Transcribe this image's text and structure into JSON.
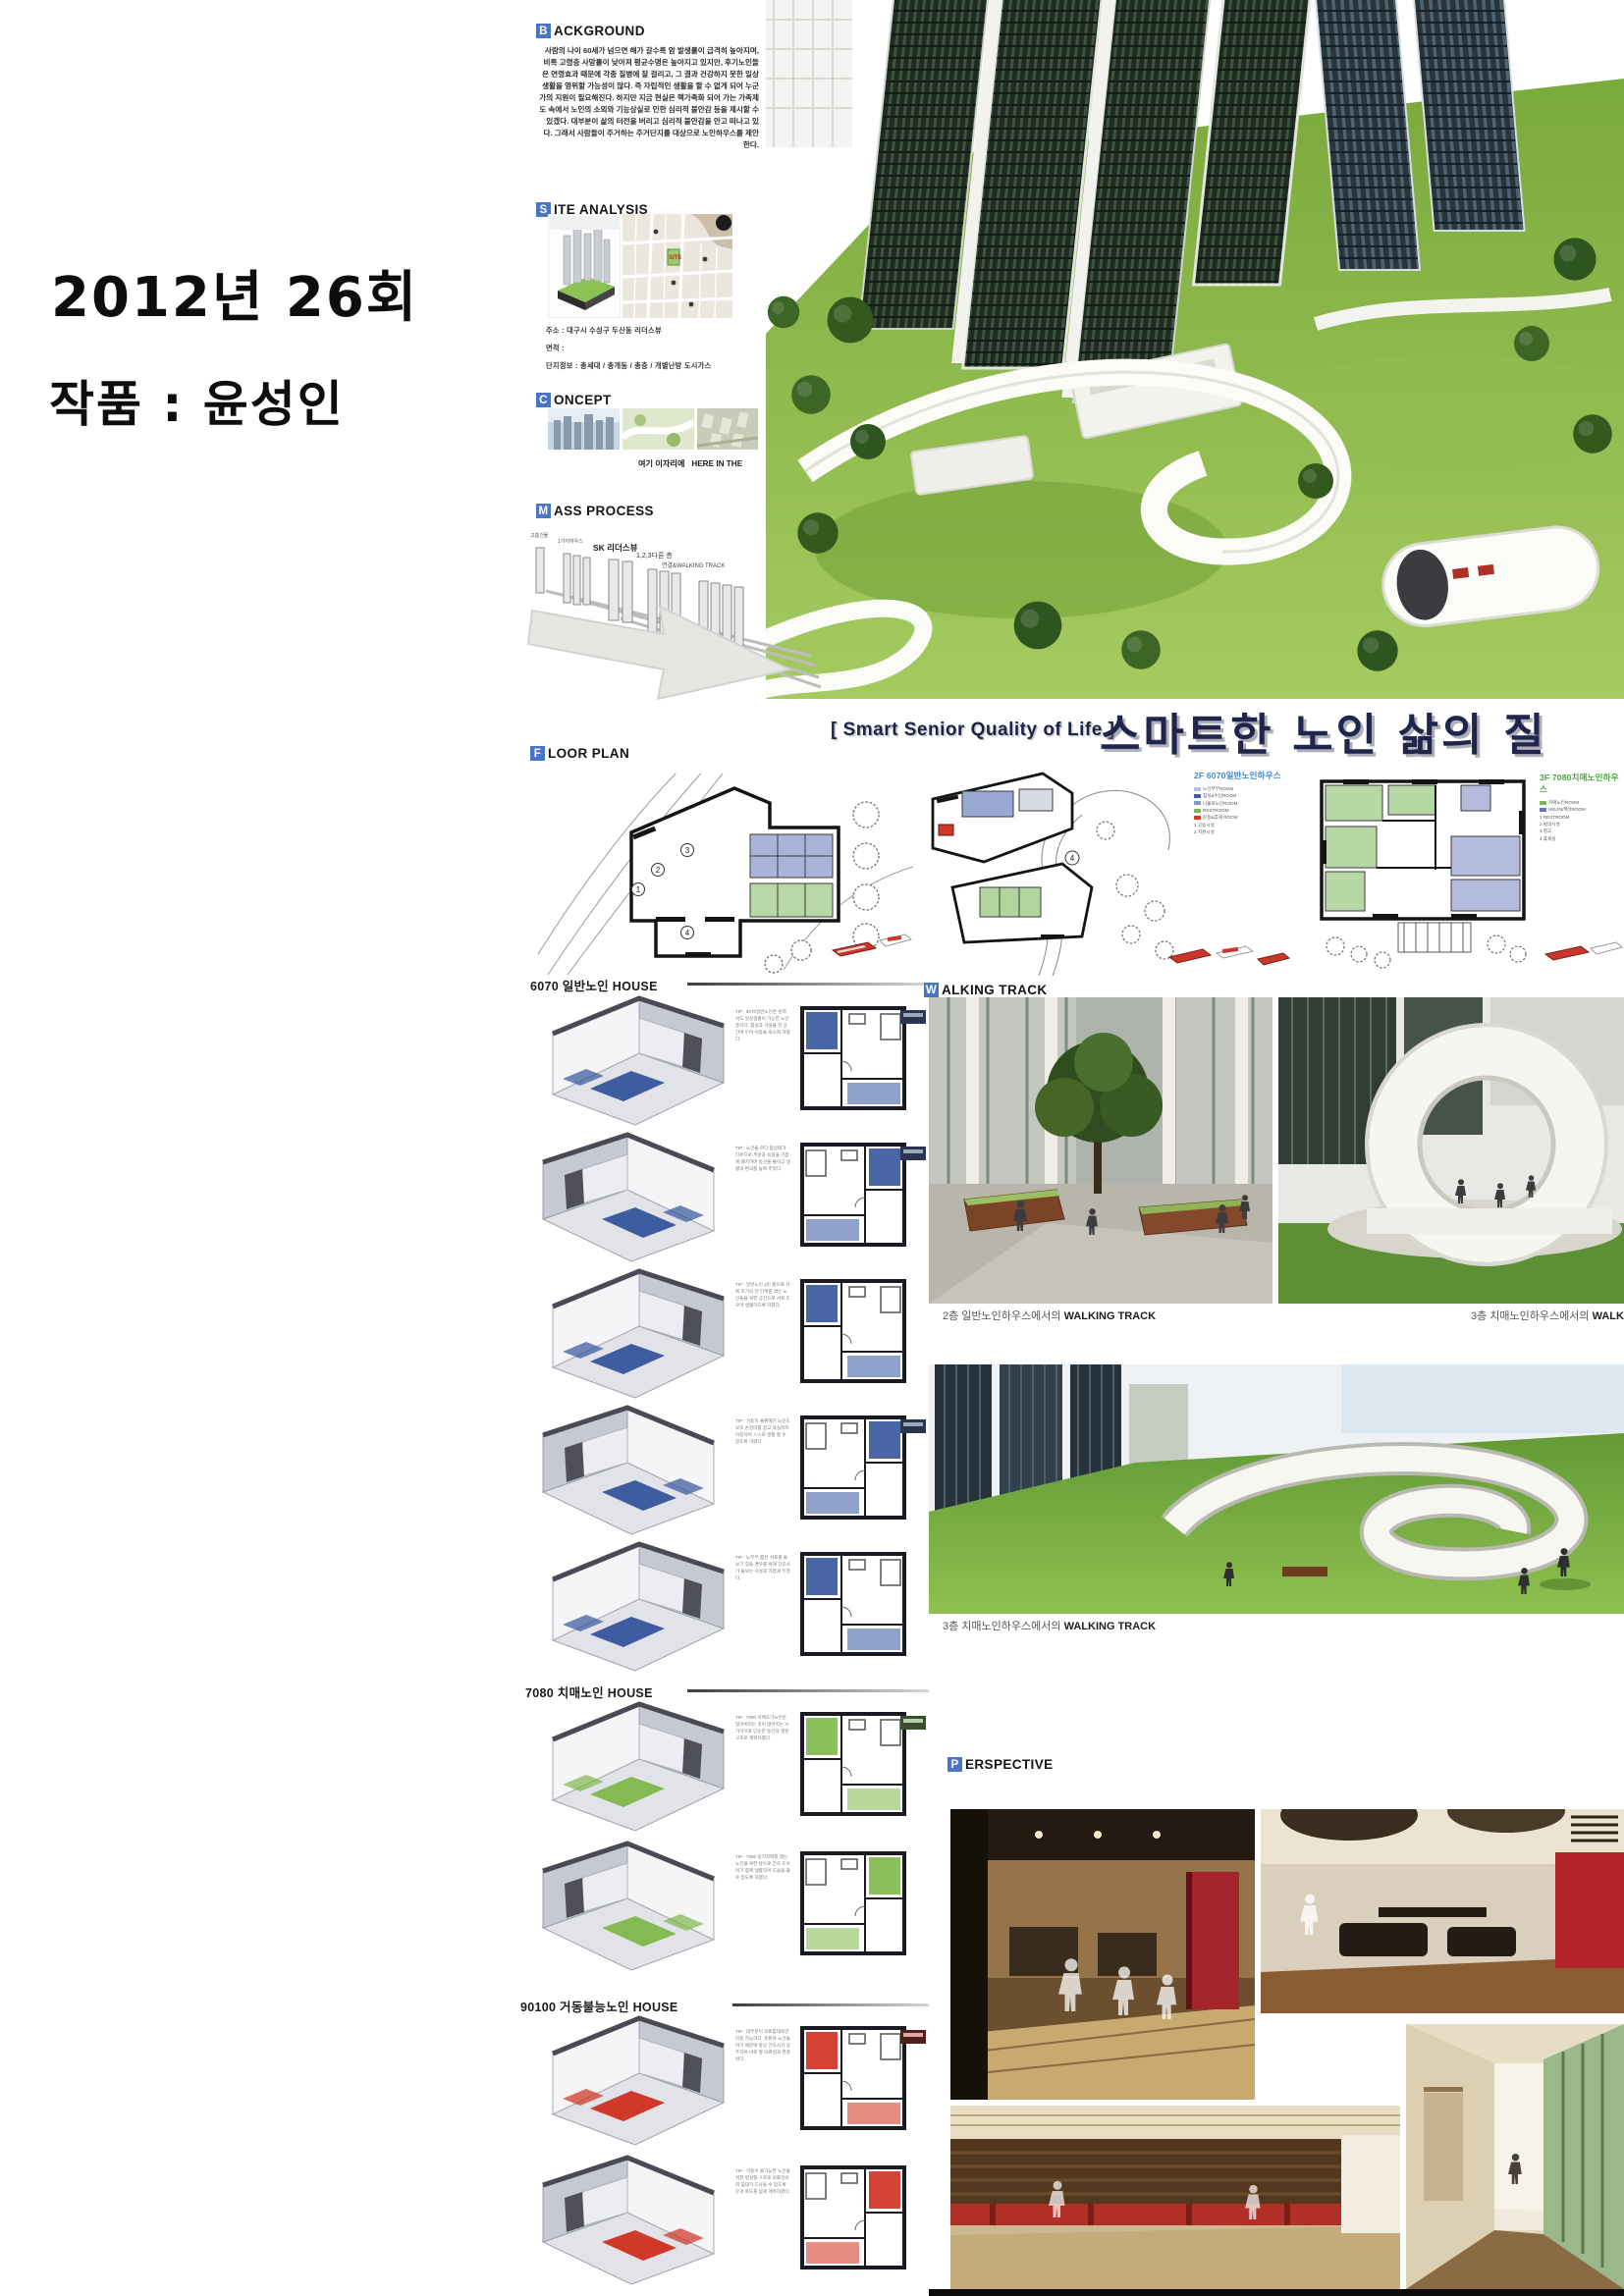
{
  "meta": {
    "title_line1": "2012년 26회",
    "title_line2": "작품 : 윤성인"
  },
  "headers": {
    "background": {
      "initial": "B",
      "rest": "ACKGROUND"
    },
    "site": {
      "initial": "S",
      "rest": "ITE ANALYSIS"
    },
    "concept": {
      "initial": "C",
      "rest": "ONCEPT"
    },
    "mass": {
      "initial": "M",
      "rest": "ASS PROCESS"
    },
    "floor": {
      "initial": "F",
      "rest": "LOOR PLAN"
    },
    "walking": {
      "initial": "W",
      "rest": "ALKING TRACK"
    },
    "perspective": {
      "initial": "P",
      "rest": "ERSPECTIVE"
    }
  },
  "background_text": "사람의 나이 60세가 넘으면 해가 갈수록 암 발생률이 급격히 높아지며, 비록 고령층 사망률이 낮아져 평균수명은 높아지고 있지만, 후기노인들은 연령효과 때문에 각종 질병에 잘 걸리고, 그 결과 건강하지 못한 일상생활을 영위할 가능성이 많다. 즉 자립적인 생활을 할 수 없게 되어 누군가의 지원이 필요해진다. 하지만 지금 현실은 핵가족화 되어 가는 가족제도 속에서 노인의 소외와 기능상실로 인한 심리적 불안감 등을 제시할 수 있겠다. 대부분이 삶의 터전을 버리고 심리적 불안감을 안고 떠나고 있다. 그래서 사람들이 주거하는 주거단지를 대상으로 노인하우스를 제안한다.",
  "site": {
    "lines": [
      "주소 : 대구시 수성구 두산동 리더스뷰",
      "면적 : ",
      "단지정보 : 총세대 / 총개동 / 총층 / 개별난방 도시가스"
    ],
    "map_site_tag": "SITE"
  },
  "concept": {
    "caption_kr": "여기 이자리에",
    "caption_en": "HERE IN THE"
  },
  "mass": {
    "labels": [
      "고층건물",
      "1가지하우스",
      "SK 리더스뷰",
      "1,2,3다른 층",
      "연결&WALKING TRACK"
    ]
  },
  "main_title": {
    "en": "[ Smart Senior Quality of Life ]",
    "kr": "스마트한 노인 삶의 질"
  },
  "floor_plans": {
    "plan2_label": "2F 6070일반노인하우스",
    "plan2_legend": [
      "노인부부ROOM",
      "침실&수납ROOM",
      "나홀로노인ROOM",
      "RESTROOM",
      "운동&휴게 ROOM",
      "1 공용시설",
      "2 지원시설"
    ],
    "plan3_label": "3F 7080치매노인하우스",
    "plan3_legend": [
      "치매노인ROOM",
      "HELP&케어ROOM",
      "1 RESTROOM",
      "2 탈의시설",
      "3 창고",
      "4 휴게실"
    ],
    "plan1_numbers": [
      "1",
      "2",
      "3",
      "4"
    ]
  },
  "unit_sections": {
    "s6070": "6070 일반노인 HOUSE",
    "s7080": "7080 치매노인 HOUSE",
    "s90100": "90100 거동불능노인 HOUSE"
  },
  "units": {
    "rows": [
      {
        "tip": "TIP : 6070일반노인은 혼자서도 일상생활이 가능한 노인층이다. 침실과 거실을 한 공간에 두어 이동을 최소화 하였다."
      },
      {
        "tip": "TIP : 노인들 마다 몸상태가 다르므로 주방과 욕실을 가깝게 배치하여 동선을 줄이고 생활의 편의를 높여 주었다."
      },
      {
        "tip": "TIP : 일반노인 2인 룸으로 치매 초기의 전 단계를 겪는 노인들을 위한 공간으로 서로 도우며 생활하도록 하였다."
      },
      {
        "tip": "TIP : 거동이 불편해진 노인도 보조 손잡이를 잡고 욕실까지 이동하며 스스로 생활 할 수 있도록 하였다."
      },
      {
        "tip": "TIP : 노부부 室은 서로를 돌보기 힘들 경우를 위해 간호사가 돌보는 시설과 가깝게 두었다."
      },
      {
        "tip": "TIP : 7080 치매초기노인은 잊어버리는 것이 많아지는 시기이므로 단순한 동선과 열린 구조로 계획하였다."
      },
      {
        "tip": "TIP : 7080 중기치매를 겪는 노인을 위한 방으로 간호 도우미가 함께 생활하며 도움을 줄 수 있도록 하였다."
      },
      {
        "tip": "TIP : 대부분이 의료침대로만 이동 가능하다. 중환자 노인들이기 때문에 항상 간호사가 상주하며 바로 옆 의료실과 연결된다."
      },
      {
        "tip": "TIP : 거동이 불가능한 노인을 위한 병실형 구조로 의료장비와 침대가 드나들 수 있도록 문과 복도를 넓게 계획하였다."
      }
    ]
  },
  "walking": {
    "caption1_prefix": "2층 일반노인하우스에서의 ",
    "caption1_bold": "WALKING TRACK",
    "caption2_prefix": "3층 치매노인하우스에서의 ",
    "caption2_bold": "WALKING T",
    "caption3_prefix": "3층 치매노인하우스에서의 ",
    "caption3_bold": "WALKING TRACK"
  },
  "colors": {
    "header_box_blue": "#4a74c4",
    "title_navy": "#20254e",
    "plan2_label_blue": "#3f86c8",
    "plan3_label_green": "#46a53c",
    "unit_blue": "#35549c",
    "unit_green": "#7db84a",
    "unit_red": "#cf2f1e"
  }
}
